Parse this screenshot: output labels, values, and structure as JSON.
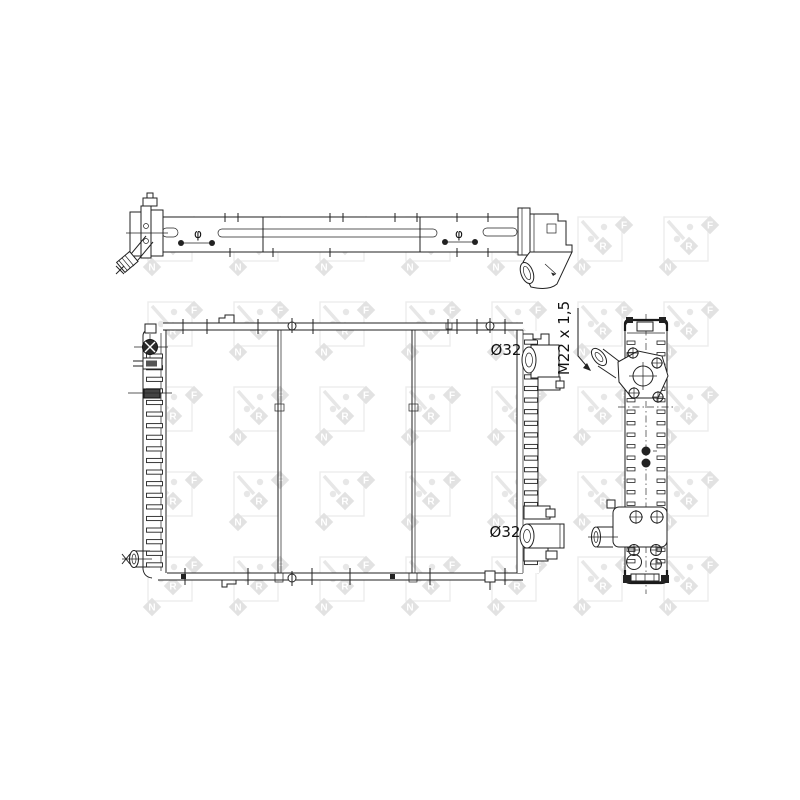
{
  "drawing": {
    "background_color": "#ffffff",
    "line_color": "#222222"
  },
  "labels": {
    "upper_port_diameter": "Ø32",
    "lower_port_diameter": "Ø32",
    "thread_spec": "M22 x 1,5",
    "phi_symbol": "φ"
  },
  "watermark": {
    "letters": [
      "N",
      "R",
      "F"
    ],
    "diamond_color": "#e2e2e2",
    "letter_color": "#ffffff"
  }
}
